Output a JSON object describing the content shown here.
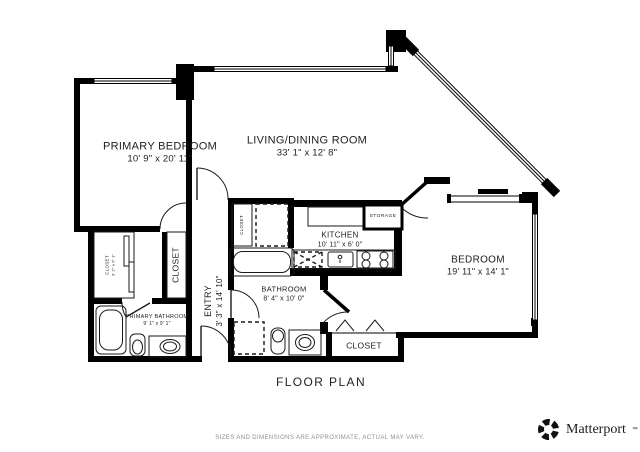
{
  "footer": {
    "title": "FLOOR PLAN",
    "disclaimer": "SIZES AND DIMENSIONS ARE APPROXIMATE, ACTUAL MAY VARY."
  },
  "brand": {
    "name": "Matterport",
    "trademark": "™"
  },
  "rooms": {
    "primary_bedroom": {
      "name": "PRIMARY BEDROOM",
      "dims": "10' 9\" x 20' 11\""
    },
    "living_dining": {
      "name": "LIVING/DINING ROOM",
      "dims": "33' 1\" x 12' 8\""
    },
    "kitchen": {
      "name": "KITCHEN",
      "dims": "10' 11\" x 6' 0\""
    },
    "bedroom": {
      "name": "BEDROOM",
      "dims": "19' 11\" x 14' 1\""
    },
    "bathroom": {
      "name": "BATHROOM",
      "dims": "8' 4\" x 10' 0\""
    },
    "primary_bathroom": {
      "name": "PRIMARY BATHROOM",
      "dims": "9' 1\" x 9' 1\""
    },
    "entry": {
      "name": "ENTRY",
      "dims": "3' 3\" x 14' 10\""
    },
    "storage": {
      "name": "STORAGE"
    },
    "closet_hall": {
      "name": "CLOSET"
    },
    "closet_primary_small": {
      "name": "CLOSET",
      "dims": "3' 2\" x 6' 1\""
    },
    "closet_bathroom": {
      "name": "CLOSET"
    },
    "closet_bedroom": {
      "name": "CLOSET"
    }
  },
  "colors": {
    "wall": "#000000",
    "text": "#1d1d1d",
    "muted": "#8f8f8f"
  }
}
